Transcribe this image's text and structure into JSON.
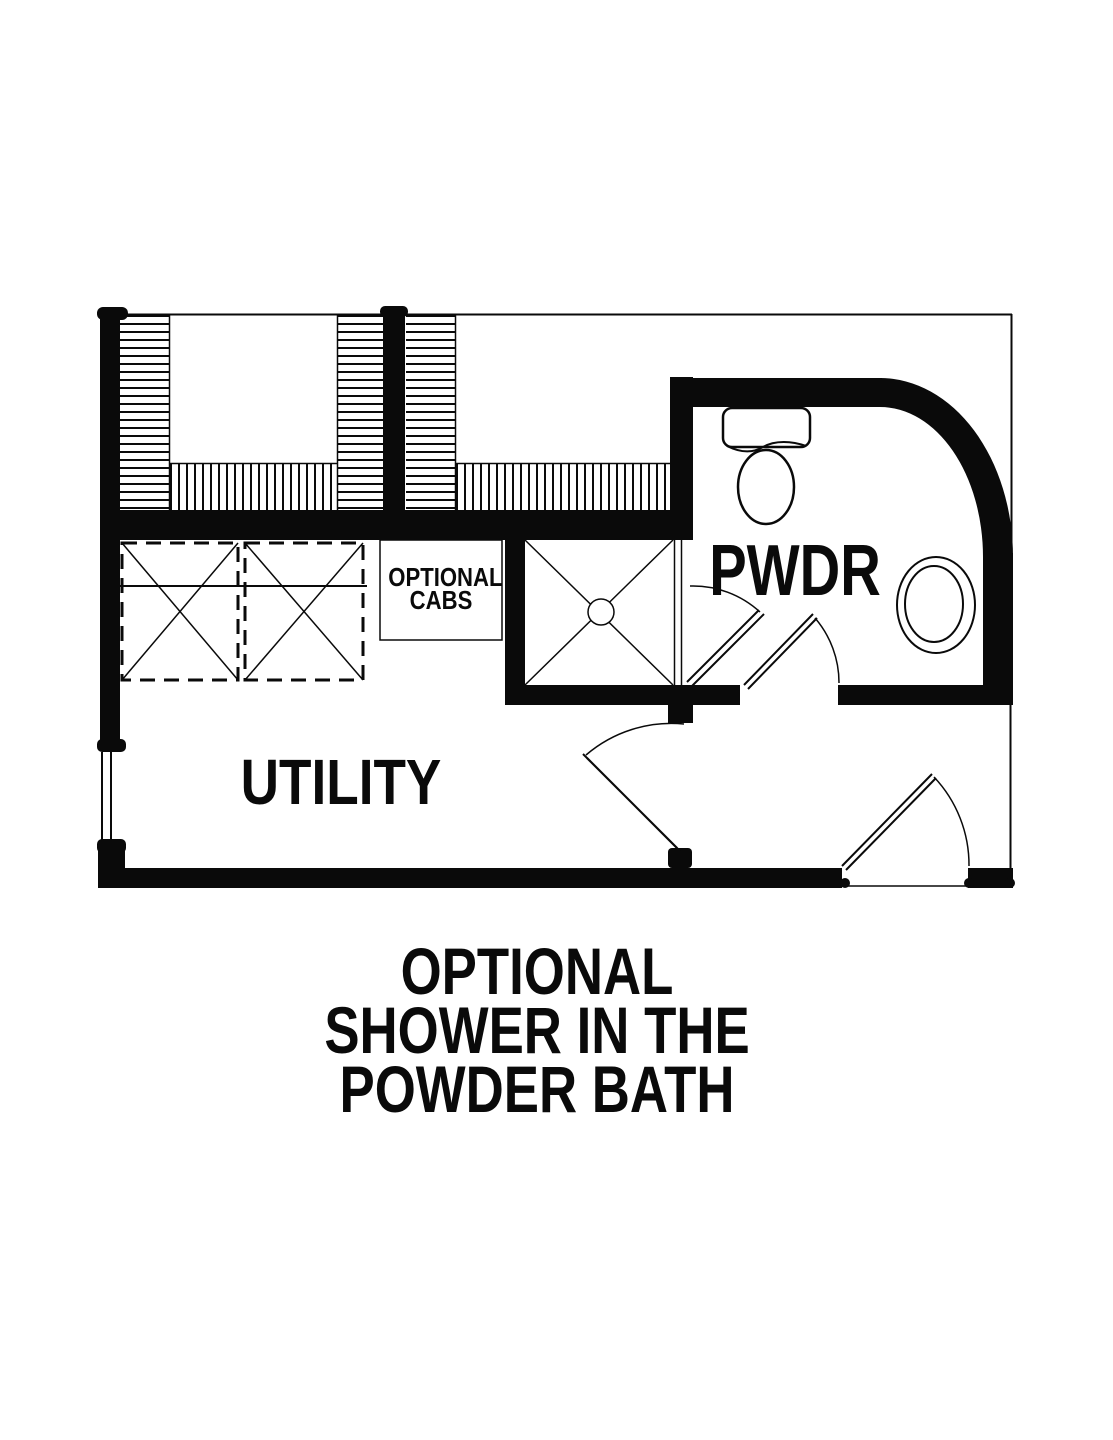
{
  "plan": {
    "labels": {
      "powder_room": "PWDR",
      "utility_room": "UTILITY",
      "optional_cabs_line1": "OPTIONAL",
      "optional_cabs_line2": "CABS"
    },
    "caption": {
      "lines": [
        "OPTIONAL",
        "SHOWER IN THE",
        "POWDER BATH"
      ]
    },
    "colors": {
      "ink": "#0a0a0a",
      "background": "#ffffff"
    }
  }
}
